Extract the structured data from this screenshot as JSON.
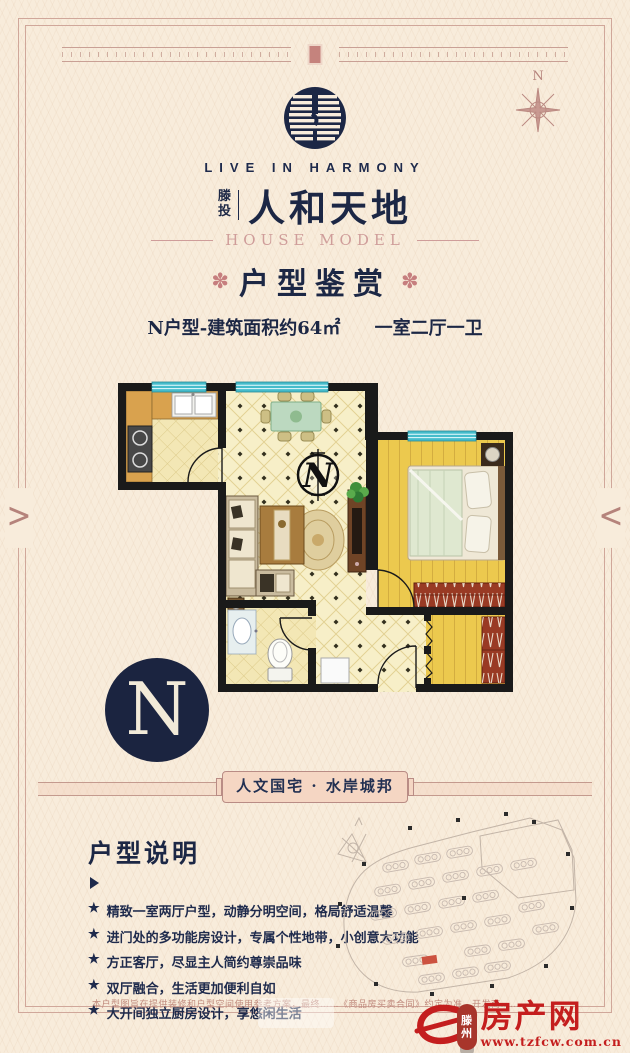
{
  "header": {
    "compass_label": "N",
    "logo_slogan": "LIVE IN HARMONY",
    "brand_prefix_top": "滕",
    "brand_prefix_bottom": "投",
    "brand_name": "人和天地",
    "subtitle": "HOUSE MODEL"
  },
  "title": {
    "ornament": "✽",
    "text": "户型鉴赏"
  },
  "unit": {
    "spec": "N户型-建筑面积约64㎡",
    "rooms": "一室二厅一卫"
  },
  "floorplan": {
    "compass_letter": "N"
  },
  "unit_badge": {
    "letter": "N"
  },
  "banner": {
    "text": "人文国宅 · 水岸城邦"
  },
  "description": {
    "title": "户型说明",
    "bullet_marker": "★",
    "bullets": [
      "精致一室两厅户型，动静分明空间，格局舒适温馨",
      "进门处的多功能房设计，专属个性地带，小创意大功能",
      "方正客厅，尽显主人简约尊崇品味",
      "双厅融合，生活更加便利自如",
      "大开间独立厨房设计，享悠闲生活"
    ]
  },
  "footer": {
    "disclaimer": "本户型图旨在提供装修和户型空间使用参考方案，最终……《商品房买卖合同》约定为准，开发商……",
    "badge_top": "滕",
    "badge_bottom": "州",
    "logo_name": "房产网",
    "logo_url": "www.tzfcw.com.cn"
  },
  "colors": {
    "navy": "#1c2745",
    "rose": "#c08a7d",
    "accent_red": "#c41e1e",
    "cream": "#f8ecdb",
    "window_teal": "#46bccb",
    "wall_black": "#1a1a1a",
    "wardrobe_red": "#993a24"
  }
}
